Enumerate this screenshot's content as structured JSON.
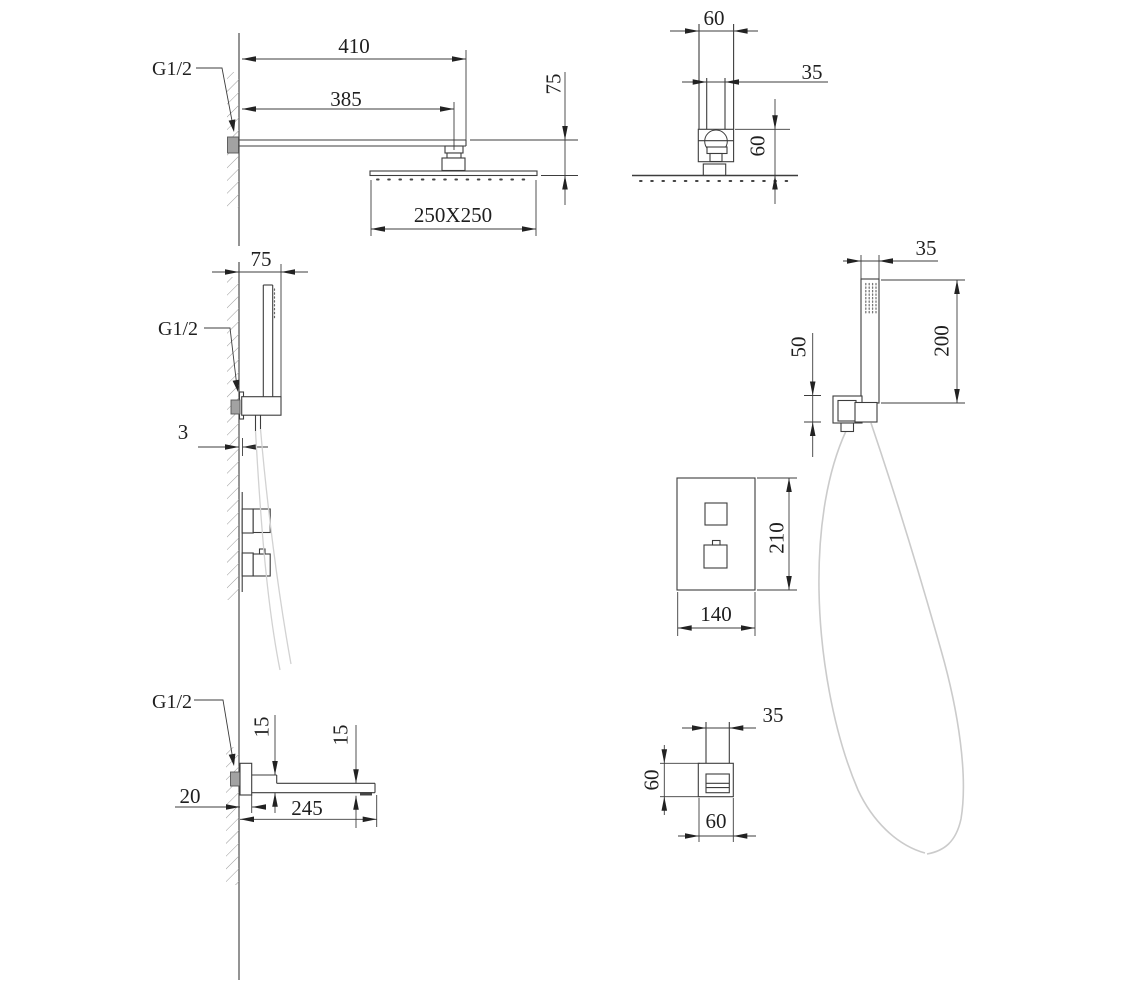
{
  "drawing_title": "shower-system-dimension-drawing",
  "views": {
    "rain_side": {
      "g_thread": "G1/2",
      "arm_total": "410",
      "arm_to_head": "385",
      "head_drop": "75",
      "head_size": "250X250"
    },
    "rain_front": {
      "outer_width": "60",
      "arm_width": "35",
      "joint_height": "60"
    },
    "hand_side": {
      "bracket_offset": "75",
      "g_thread": "G1/2",
      "plate_thickness": "3"
    },
    "hand_front": {
      "handle_width": "35",
      "handle_length": "200",
      "bracket_height": "50"
    },
    "mixer_front": {
      "plate_height": "210",
      "plate_width": "140"
    },
    "spout_side": {
      "g_thread": "G1/2",
      "inlet_height": "15",
      "outlet_height": "15",
      "wall_depth": "20",
      "length": "245"
    },
    "spout_front": {
      "tube_width": "35",
      "plate_height": "60",
      "plate_width": "60"
    }
  }
}
